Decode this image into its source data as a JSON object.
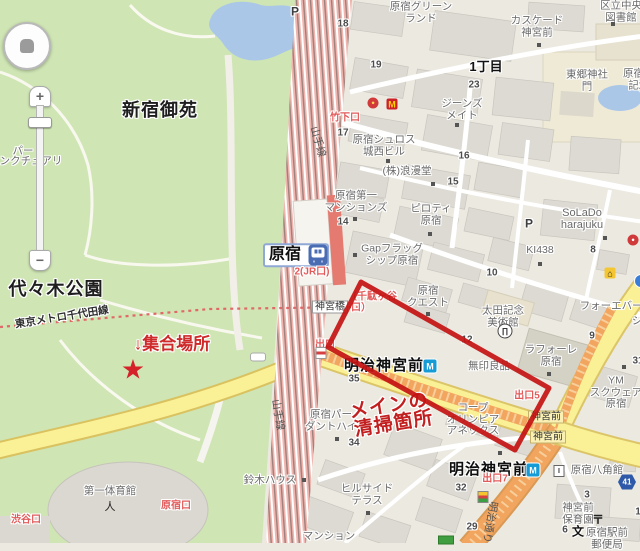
{
  "map": {
    "colors": {
      "park_green": "#cfe5b4",
      "water_blue": "#abc7e8",
      "road_yellow": "#faf096",
      "road_orange": "#f2a55e",
      "railway_pink": "#f0b5ae",
      "annotation_red": "#c41212",
      "exit_red": "#e25b5b",
      "metro_blue": "#159bd5",
      "jr_blue": "#4a6cb3",
      "city_bg": "#ece9e1"
    },
    "controls": {
      "zoom_in": "+",
      "zoom_out": "−"
    },
    "labels": [
      {
        "n": "label-shinjuku-gyoen",
        "t": "新宿御苑",
        "x": 160,
        "y": 111,
        "c": "big"
      },
      {
        "n": "label-yoyogi-park",
        "t": "代々木公園",
        "x": 56,
        "y": 290,
        "c": "big"
      },
      {
        "n": "label-1chome",
        "t": "1丁目",
        "x": 486,
        "y": 67,
        "c": "big2"
      },
      {
        "n": "label-harajuku-greenland",
        "lines": [
          "原宿グリーン",
          "ランド"
        ],
        "x": 421,
        "y": 13,
        "c": "bldg"
      },
      {
        "n": "label-cascade-jingumae",
        "lines": [
          "カスケード",
          "神宮前"
        ],
        "x": 537,
        "y": 27,
        "c": "bldg"
      },
      {
        "n": "label-togo-shrine",
        "lines": [
          "東郷神社",
          "門"
        ],
        "x": 587,
        "y": 81,
        "c": "bldg"
      },
      {
        "n": "label-central-library",
        "lines": [
          "区立中央",
          "図書館"
        ],
        "x": 621,
        "y": 12,
        "c": "bldg"
      },
      {
        "n": "label-togo-memorial",
        "lines": [
          "原宿東郷",
          "記念館"
        ],
        "x": 644,
        "y": 80,
        "c": "bldg"
      },
      {
        "n": "label-jeans-mate",
        "lines": [
          "ジーンズ",
          "メイト"
        ],
        "x": 462,
        "y": 110,
        "c": "bldg"
      },
      {
        "n": "label-harajuku-schloss",
        "lines": [
          "原宿シュロス",
          "城西ビル"
        ],
        "x": 384,
        "y": 146,
        "c": "bldg"
      },
      {
        "n": "label-romando",
        "t": "(株)浪漫堂",
        "x": 407,
        "y": 172,
        "c": "bldg"
      },
      {
        "n": "label-daiichi-mansions",
        "lines": [
          "原宿第一",
          "マンションズ"
        ],
        "x": 356,
        "y": 202,
        "c": "bldg"
      },
      {
        "n": "label-piloti-harajuku",
        "lines": [
          "ピロティ",
          "原宿"
        ],
        "x": 431,
        "y": 215,
        "c": "bldg"
      },
      {
        "n": "label-gap-flagship",
        "lines": [
          "Gapフラッグ",
          "シップ原宿"
        ],
        "x": 392,
        "y": 255,
        "c": "bldg"
      },
      {
        "n": "label-solado",
        "lines": [
          "SoLaDo",
          "harajuku"
        ],
        "x": 582,
        "y": 219,
        "c": "bldg11"
      },
      {
        "n": "label-ki438",
        "t": "KI438",
        "x": 540,
        "y": 251,
        "c": "bldg"
      },
      {
        "n": "label-harajuku-quest",
        "lines": [
          "原宿",
          "クエスト"
        ],
        "x": 428,
        "y": 297,
        "c": "bldg"
      },
      {
        "n": "label-ota-museum",
        "lines": [
          "太田記念",
          "美術館"
        ],
        "x": 503,
        "y": 317,
        "c": "bldg"
      },
      {
        "n": "label-forever21",
        "t": "フォーエバー21",
        "x": 617,
        "y": 307,
        "c": "bldg"
      },
      {
        "n": "label-shi-fragment",
        "t": "シ",
        "x": 637,
        "y": 322,
        "c": "bldg"
      },
      {
        "n": "label-laforet",
        "lines": [
          "ラフォーレ",
          "原宿"
        ],
        "x": 551,
        "y": 356,
        "c": "bldg"
      },
      {
        "n": "label-muji",
        "t": "無印良品",
        "x": 489,
        "y": 367,
        "c": "bldg"
      },
      {
        "n": "label-ym-square",
        "lines": [
          "YM",
          "スクウェア",
          "原宿"
        ],
        "x": 616,
        "y": 393,
        "c": "bldg"
      },
      {
        "n": "label-coop-olympia",
        "lines": [
          "コープ",
          "オリンピア",
          "アネックス"
        ],
        "x": 473,
        "y": 420,
        "c": "bldg"
      },
      {
        "n": "label-hakkakukan",
        "t": "原宿八角館",
        "x": 597,
        "y": 471,
        "c": "bldg"
      },
      {
        "n": "label-jingumae-nursery",
        "lines": [
          "神宮前",
          "保育園"
        ],
        "x": 578,
        "y": 514,
        "c": "bldg"
      },
      {
        "n": "label-post-office",
        "lines": [
          "原宿駅前",
          "郵便局"
        ],
        "x": 607,
        "y": 539,
        "c": "bldg"
      },
      {
        "n": "label-hillside-terrace",
        "lines": [
          "ヒルサイド",
          "テラス"
        ],
        "x": 367,
        "y": 495,
        "c": "bldg"
      },
      {
        "n": "label-pardant-hai",
        "lines": [
          "原宿パー",
          "ダントハイ"
        ],
        "x": 331,
        "y": 421,
        "c": "bldg"
      },
      {
        "n": "label-suzuki-house",
        "t": "鈴木ハウス",
        "x": 270,
        "y": 481,
        "c": "bldg"
      },
      {
        "n": "label-mansion",
        "t": "マンション",
        "x": 329,
        "y": 537,
        "c": "bldg"
      },
      {
        "n": "label-daiichi-gym",
        "t": "第一体育館",
        "x": 110,
        "y": 492,
        "c": "bldg"
      },
      {
        "n": "label-bird-sanctuary-1",
        "t": "パー",
        "x": 23,
        "y": 152,
        "c": "bldg"
      },
      {
        "n": "label-bird-sanctuary-2",
        "t": "ンクチュアリ",
        "x": 31,
        "y": 162,
        "c": "bldg"
      },
      {
        "n": "block-number",
        "t": "18",
        "x": 343,
        "y": 24,
        "c": "num"
      },
      {
        "n": "block-number",
        "t": "19",
        "x": 376,
        "y": 65,
        "c": "num"
      },
      {
        "n": "block-number",
        "t": "23",
        "x": 474,
        "y": 85,
        "c": "num"
      },
      {
        "n": "block-number",
        "t": "17",
        "x": 343,
        "y": 133,
        "c": "num"
      },
      {
        "n": "block-number",
        "t": "16",
        "x": 464,
        "y": 156,
        "c": "num"
      },
      {
        "n": "block-number",
        "t": "15",
        "x": 453,
        "y": 182,
        "c": "num"
      },
      {
        "n": "block-number",
        "t": "14",
        "x": 343,
        "y": 222,
        "c": "num"
      },
      {
        "n": "block-number",
        "t": "10",
        "x": 492,
        "y": 273,
        "c": "num"
      },
      {
        "n": "block-number",
        "t": "8",
        "x": 593,
        "y": 250,
        "c": "num"
      },
      {
        "n": "block-number",
        "t": "12",
        "x": 467,
        "y": 340,
        "c": "num"
      },
      {
        "n": "block-number",
        "t": "9",
        "x": 592,
        "y": 336,
        "c": "num"
      },
      {
        "n": "block-number",
        "t": "35",
        "x": 354,
        "y": 379,
        "c": "num"
      },
      {
        "n": "block-number",
        "t": "34",
        "x": 354,
        "y": 443,
        "c": "num"
      },
      {
        "n": "block-number",
        "t": "31",
        "x": 638,
        "y": 361,
        "c": "num"
      },
      {
        "n": "block-number",
        "t": "32",
        "x": 461,
        "y": 488,
        "c": "num"
      },
      {
        "n": "block-number",
        "t": "29",
        "x": 472,
        "y": 527,
        "c": "num"
      },
      {
        "n": "block-number",
        "t": "3",
        "x": 587,
        "y": 495,
        "c": "num"
      },
      {
        "n": "block-number",
        "t": "6",
        "x": 565,
        "y": 530,
        "c": "num"
      },
      {
        "n": "block-number",
        "t": "1",
        "x": 638,
        "y": 512,
        "c": "num"
      },
      {
        "n": "label-harajuku-station",
        "t": "原宿",
        "x": 296,
        "y": 255,
        "c": "stationbox"
      },
      {
        "n": "label-meiji-jingumae-station-1",
        "t": "明治神宮前",
        "x": 384,
        "y": 366,
        "c": "station"
      },
      {
        "n": "label-meiji-jingumae-station-2",
        "t": "明治神宮前",
        "x": 489,
        "y": 470,
        "c": "station"
      },
      {
        "n": "label-jingubashi",
        "t": "神宮橋",
        "x": 330,
        "y": 307,
        "c": "wbox"
      },
      {
        "n": "label-jingumae-box-1",
        "t": "神宮前",
        "x": 546,
        "y": 417,
        "c": "ybox"
      },
      {
        "n": "label-jingumae-box-2",
        "t": "神宮前",
        "x": 548,
        "y": 437,
        "c": "ybox"
      },
      {
        "n": "label-takeshita-exit",
        "t": "竹下口",
        "x": 345,
        "y": 118,
        "c": "exit"
      },
      {
        "n": "label-exit2-jr",
        "t": "2(JR口)",
        "x": 312,
        "y": 272,
        "c": "exit"
      },
      {
        "n": "label-sendagaya-frag-1",
        "t": "（千駄ヶ谷",
        "x": 372,
        "y": 297,
        "c": "exit"
      },
      {
        "n": "label-sendagaya-frag-2",
        "t": "口）",
        "x": 361,
        "y": 308,
        "c": "exit"
      },
      {
        "n": "label-exit",
        "t": "出口",
        "x": 325,
        "y": 345,
        "c": "exit"
      },
      {
        "n": "label-exit5",
        "t": "出口5",
        "x": 527,
        "y": 396,
        "c": "exit"
      },
      {
        "n": "label-exit7",
        "t": "出口7",
        "x": 495,
        "y": 479,
        "c": "exit"
      },
      {
        "n": "label-shibuya-exit",
        "t": "渋谷口",
        "x": 26,
        "y": 520,
        "c": "exit"
      },
      {
        "n": "label-harajuku-exit",
        "t": "原宿口",
        "x": 176,
        "y": 506,
        "c": "exit"
      },
      {
        "n": "label-yamanote-line-1",
        "t": "山手線",
        "x": 317,
        "y": 142,
        "c": "road",
        "r": 74
      },
      {
        "n": "label-yamanote-line-2",
        "t": "山手線",
        "x": 277,
        "y": 415,
        "c": "road",
        "r": 80
      },
      {
        "n": "label-meiji-dori",
        "t": "明治通り",
        "x": 489,
        "y": 522,
        "c": "road",
        "r": 100
      },
      {
        "n": "label-chiyoda-line",
        "t": "東京メトロ千代田線",
        "x": 62,
        "y": 318,
        "c": "mline",
        "r": -9
      },
      {
        "n": "annotation-meeting-place",
        "t": "↓集合場所",
        "x": 172,
        "y": 345,
        "c": "hand"
      },
      {
        "n": "annotation-main-cleaning-1",
        "t": "メインの",
        "x": 389,
        "y": 407,
        "c": "hand2",
        "r": -9
      },
      {
        "n": "annotation-main-cleaning-2",
        "t": "清掃箇所",
        "x": 394,
        "y": 425,
        "c": "hand2",
        "r": -9
      },
      {
        "n": "parking-label",
        "t": "P",
        "x": 295,
        "y": 12,
        "c": "plbl"
      },
      {
        "n": "parking-label",
        "t": "P",
        "x": 529,
        "y": 224,
        "c": "plbl"
      }
    ],
    "icons": [
      {
        "n": "jr-train-icon",
        "k": "jr",
        "x": 318,
        "y": 255
      },
      {
        "n": "metro-logo-icon",
        "k": "metro",
        "x": 430,
        "y": 366,
        "g": "M"
      },
      {
        "n": "metro-logo-icon",
        "k": "metro",
        "x": 533,
        "y": 470,
        "g": "M"
      },
      {
        "n": "mcdonalds-icon",
        "k": "mcd",
        "x": 392,
        "y": 104,
        "g": "M"
      },
      {
        "n": "restaurant-icon",
        "k": "circle-red",
        "x": 373,
        "y": 103,
        "g": "●"
      },
      {
        "n": "solado-poi-icon",
        "k": "circle-red2",
        "x": 633,
        "y": 240,
        "g": "●"
      },
      {
        "n": "hotel-icon",
        "k": "hotel",
        "x": 610,
        "y": 273,
        "g": "⌂"
      },
      {
        "n": "blue-poi-icon",
        "k": "bluec",
        "x": 641,
        "y": 281
      },
      {
        "n": "museum-icon",
        "k": "museum",
        "x": 505,
        "y": 331,
        "g": "∏"
      },
      {
        "n": "post-office-icon",
        "k": "post",
        "x": 598,
        "y": 519,
        "g": "〒"
      },
      {
        "n": "school-icon",
        "k": "school",
        "x": 578,
        "y": 531,
        "g": "文"
      },
      {
        "n": "route-41-shield",
        "k": "shield",
        "x": 627,
        "y": 482,
        "g": "41"
      },
      {
        "n": "meeting-star-icon",
        "k": "star",
        "x": 133,
        "y": 370,
        "g": "★"
      },
      {
        "n": "elevator-stripes-icon",
        "k": "stripea",
        "x": 321,
        "y": 353
      },
      {
        "n": "poi-stripes-icon",
        "k": "stripeb",
        "x": 483,
        "y": 497
      },
      {
        "n": "green-bar-icon",
        "k": "greenbar",
        "x": 446,
        "y": 540
      },
      {
        "n": "route-pill-icon",
        "k": "wpill",
        "x": 258,
        "y": 357
      },
      {
        "n": "hakkakukan-poi-icon",
        "k": "poi",
        "x": 559,
        "y": 471,
        "g": "I"
      },
      {
        "n": "gym-poi-icon",
        "k": "sport",
        "x": 110,
        "y": 506,
        "g": "人"
      },
      {
        "n": "poi-dot",
        "k": "dot",
        "x": 539,
        "y": 45
      },
      {
        "n": "poi-dot",
        "k": "dot",
        "x": 613,
        "y": 24
      },
      {
        "n": "poi-dot",
        "k": "dot",
        "x": 457,
        "y": 125
      },
      {
        "n": "poi-dot",
        "k": "dot",
        "x": 388,
        "y": 161
      },
      {
        "n": "poi-dot",
        "k": "dot",
        "x": 433,
        "y": 184
      },
      {
        "n": "poi-dot",
        "k": "dot",
        "x": 355,
        "y": 219
      },
      {
        "n": "poi-dot",
        "k": "dot",
        "x": 430,
        "y": 234
      },
      {
        "n": "poi-dot",
        "k": "dot",
        "x": 355,
        "y": 255
      },
      {
        "n": "poi-dot",
        "k": "dot",
        "x": 605,
        "y": 238
      },
      {
        "n": "poi-dot",
        "k": "dot",
        "x": 540,
        "y": 264
      },
      {
        "n": "poi-dot",
        "k": "dot",
        "x": 428,
        "y": 314
      },
      {
        "n": "poi-dot",
        "k": "dot",
        "x": 549,
        "y": 374
      },
      {
        "n": "poi-dot",
        "k": "dot",
        "x": 624,
        "y": 367
      },
      {
        "n": "poi-dot",
        "k": "dot",
        "x": 500,
        "y": 453
      },
      {
        "n": "poi-dot",
        "k": "dot",
        "x": 368,
        "y": 513
      },
      {
        "n": "poi-dot",
        "k": "dot",
        "x": 337,
        "y": 439
      },
      {
        "n": "poi-dot",
        "k": "dot",
        "x": 304,
        "y": 480
      }
    ]
  }
}
